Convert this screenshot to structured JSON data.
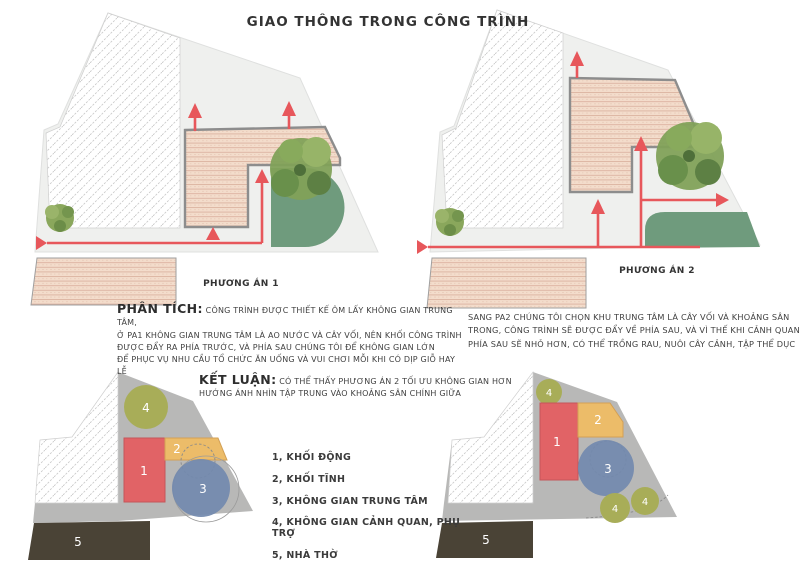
{
  "title": "GIAO THÔNG TRONG CÔNG TRÌNH",
  "plans": {
    "plan1_label": "PHƯƠNG ÁN 1",
    "plan2_label": "PHƯƠNG ÁN 2"
  },
  "analysis": {
    "heading": "PHÂN TÍCH:",
    "body": "CÔNG TRÌNH ĐƯỢC THIẾT KẾ ÔM LẤY KHÔNG GIAN TRUNG TÂM,\nỞ PA1 KHÔNG GIAN TRUNG TÂM LÀ AO NƯỚC VÀ CÂY VỐI, NÊN KHỐI CÔNG TRÌNH\nĐƯỢC ĐẨY RA PHÍA TRƯỚC, VÀ PHÍA SAU CHÚNG TÔI ĐỂ KHÔNG GIAN LỚN\nĐỂ PHỤC VỤ NHU CẦU TỔ CHỨC ĂN UỐNG VÀ VUI CHƠI MỖI KHI CÓ DỊP GIỖ HAY LỄ"
  },
  "analysis_pa2": {
    "body": "SANG PA2 CHÚNG TÔI CHỌN KHU TRUNG TÂM LÀ CÂY VỐI VÀ KHOẢNG SÂN\nTRONG, CÔNG TRÌNH SẼ ĐƯỢC ĐẨY VỀ PHÍA SAU, VÀ VÌ THẾ KHI CẢNH QUAN\nPHÍA SAU SẼ NHỎ HƠN, CÓ THỂ TRỒNG RAU, NUÔI CÂY CẢNH, TẬP THỂ DỤC"
  },
  "conclusion": {
    "heading": "KẾT LUẬN:",
    "body": "CÓ THỂ THẤY PHƯƠNG ÁN 2 TỐI ƯU KHÔNG GIAN HƠN\nHƯỚNG ÁNH NHÌN TẬP TRUNG VÀO KHOẢNG SÂN CHÍNH GIỮA"
  },
  "legend": {
    "items": [
      {
        "label": "1, KHỐI ĐỘNG"
      },
      {
        "label": "2, KHỐI TĨNH"
      },
      {
        "label": "3, KHÔNG GIAN TRUNG TÂM"
      },
      {
        "label": "4, KHÔNG GIAN CẢNH QUAN, PHỤ TRỢ"
      },
      {
        "label": "5, NHÀ THỜ"
      }
    ]
  },
  "zone_numbers": {
    "n1": "1",
    "n2": "2",
    "n3": "3",
    "n4": "4",
    "n5": "5"
  },
  "colors": {
    "flow_arrow_red": "#e7575b",
    "roof_hatch_pink": "#f3dccb",
    "roof_stripe": "#dcb3a0",
    "site_light_gray": "#eff0ee",
    "site_dark_gray": "#b8b8b7",
    "neighbor_hatch_line": "#c8c8c8",
    "garden_green": "#6f9b7d",
    "tree_green": "#81a159",
    "zone1_red": "#e16366",
    "zone2_orange": "#ecbc69",
    "zone3_blue": "#7289ae",
    "zone4_olive": "#a8ad58",
    "zone5_brown": "#4a4336"
  }
}
